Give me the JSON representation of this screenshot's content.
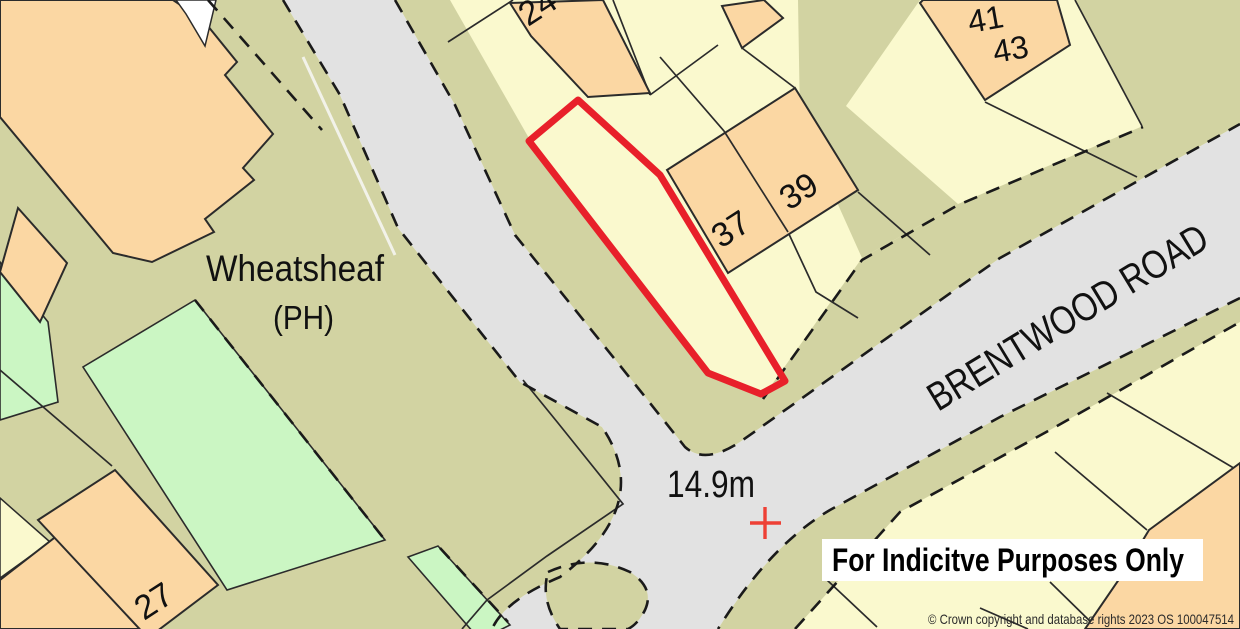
{
  "map": {
    "labels": {
      "pub_name": "Wheatsheaf",
      "pub_type": "(PH)",
      "road_name": "BRENTWOOD ROAD",
      "spot_height": "14.9m",
      "house_numbers": {
        "n24": "24",
        "n27": "27",
        "n37": "37",
        "n39": "39",
        "n41": "41",
        "n43": "43"
      }
    },
    "notice": "For Indicitve Purposes Only",
    "attribution": "© Crown copyright and database rights 2023 OS 100047514",
    "colors": {
      "building": "#FBD7A3",
      "plot": "#FAF9CE",
      "verge": "#D2D3A2",
      "road": "#E2E2E2",
      "green": "#CBF6C3",
      "outline_red": "#E8202A",
      "cross_red": "#EE4035",
      "line": "#2B2B2B",
      "banner_bg": "#FFFFFF"
    }
  }
}
